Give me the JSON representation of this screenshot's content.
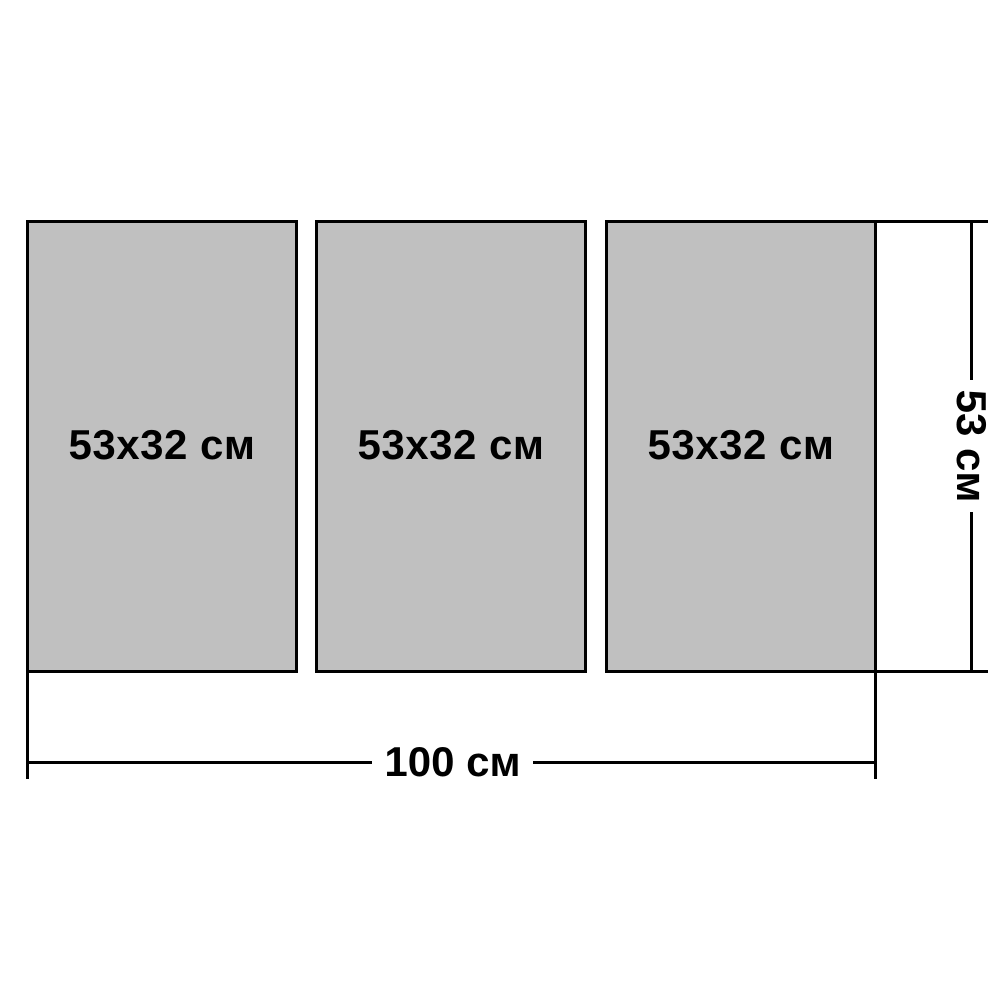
{
  "diagram": {
    "panels": [
      {
        "label": "53x32 см"
      },
      {
        "label": "53x32 см"
      },
      {
        "label": "53x32 см"
      }
    ],
    "dimensions": {
      "total_width_label": "100 см",
      "panel_height_label": "53 см"
    },
    "colors": {
      "panel_fill": "#c0c0c0",
      "panel_border": "#000000",
      "dimension_line": "#000000",
      "background": "#ffffff"
    }
  }
}
